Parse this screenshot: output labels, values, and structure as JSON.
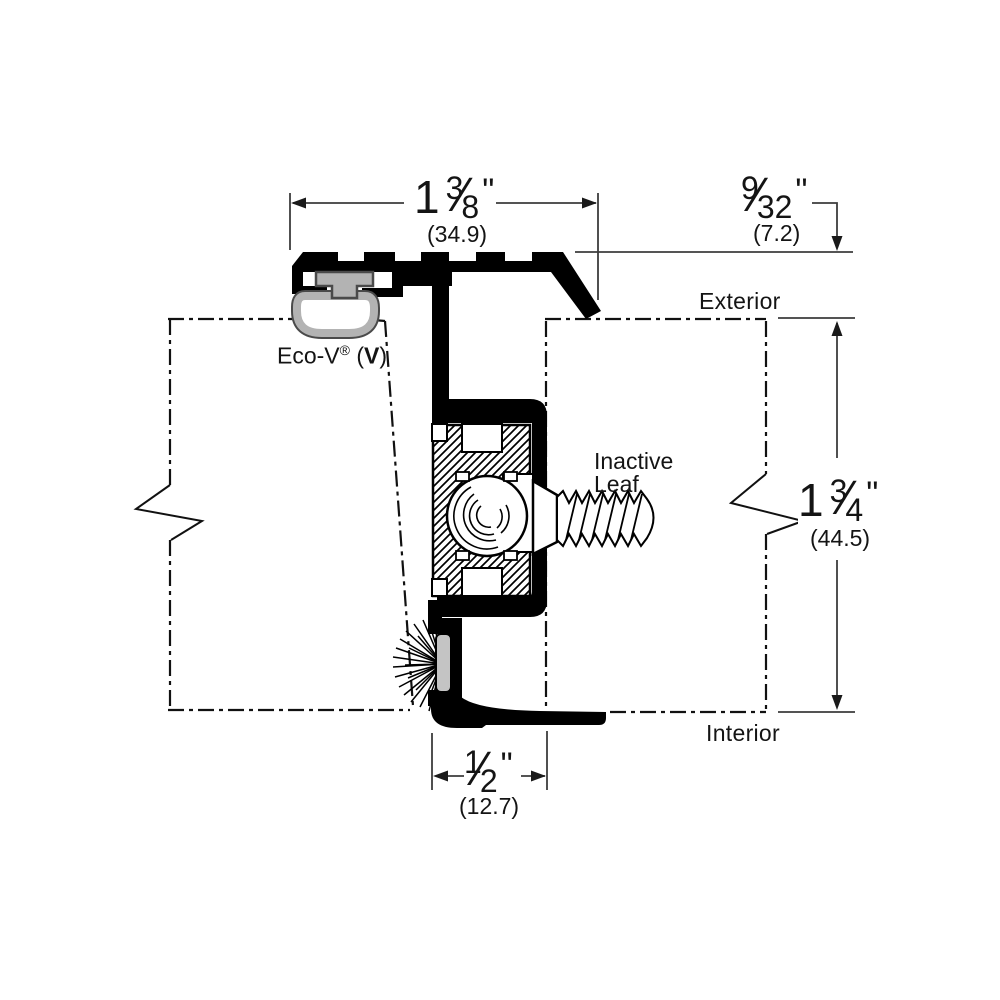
{
  "ui": {
    "fraction_slash": "⁄"
  },
  "labels": {
    "exterior": "Exterior",
    "interior": "Interior",
    "inactive_leaf": {
      "line1": "Inactive",
      "line2": "Leaf"
    },
    "eco_v": {
      "name": "Eco-V",
      "registered": "®",
      "open": " (",
      "bold_letter": "V",
      "close": ")"
    }
  },
  "dims": {
    "top_width": {
      "whole": "1",
      "numerator": "3",
      "denominator": "8",
      "unit": "\"",
      "metric": "(34.9)"
    },
    "reveal_height": {
      "numerator": "9",
      "denominator": "32",
      "unit": "\"",
      "metric": "(7.2)"
    },
    "door_thickness": {
      "whole": "1",
      "numerator": "3",
      "denominator": "4",
      "unit": "\"",
      "metric": "(44.5)"
    },
    "bottom_width": {
      "numerator": "1",
      "denominator": "2",
      "unit": "\"",
      "metric": "(12.7)"
    }
  },
  "colors": {
    "ink": "#000000",
    "thin_line": "#3d3d3d",
    "seal_gray": "#b3b3b3",
    "brush_gray": "#c4c4c4",
    "background": "#ffffff"
  }
}
